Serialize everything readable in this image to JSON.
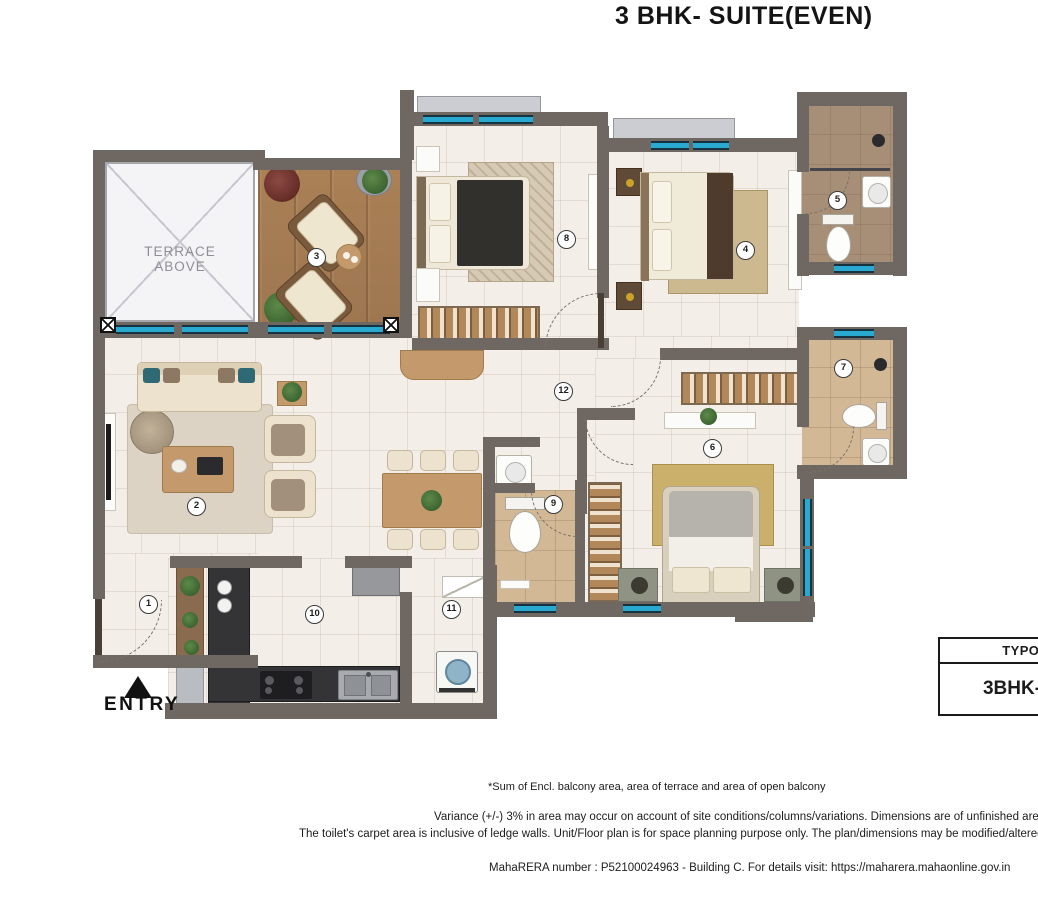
{
  "title": "3 BHK- SUITE(EVEN)",
  "plan": {
    "terrace_label_line1": "TERRACE",
    "terrace_label_line2": "ABOVE",
    "entry_label": "ENTRY",
    "rooms": [
      {
        "number": "1",
        "x": 148,
        "y": 604
      },
      {
        "number": "2",
        "x": 196,
        "y": 506
      },
      {
        "number": "3",
        "x": 316,
        "y": 257
      },
      {
        "number": "4",
        "x": 745,
        "y": 250
      },
      {
        "number": "5",
        "x": 837,
        "y": 200
      },
      {
        "number": "6",
        "x": 712,
        "y": 448
      },
      {
        "number": "7",
        "x": 843,
        "y": 368
      },
      {
        "number": "8",
        "x": 566,
        "y": 239
      },
      {
        "number": "9",
        "x": 553,
        "y": 504
      },
      {
        "number": "10",
        "x": 314,
        "y": 614
      },
      {
        "number": "11",
        "x": 451,
        "y": 609
      },
      {
        "number": "12",
        "x": 563,
        "y": 391
      }
    ]
  },
  "typology_table": {
    "header": "TYPOLOGY",
    "value": "3BHK-SUITE"
  },
  "notes": {
    "note1": "*Sum of Encl. balcony area, area of terrace and area of open balcony",
    "note2": "Variance (+/-) 3% in area may occur on account of site conditions/columns/variations. Dimensions are of unfinished areas",
    "note3": "The toilet's carpet area is inclusive of ledge walls. Unit/Floor plan is for space planning purpose only. The plan/dimensions may be modified/altered",
    "note4": "MahaRERA number : P52100024963 - Building C. For details visit: https://maharera.mahaonline.gov.in"
  },
  "colors": {
    "wall": "#6f6862",
    "window": "#29a9cf",
    "deck_wood": "#a87d52",
    "bath_tile": "#d3b896",
    "counter": "#343436",
    "floor": "#f3eee7"
  }
}
